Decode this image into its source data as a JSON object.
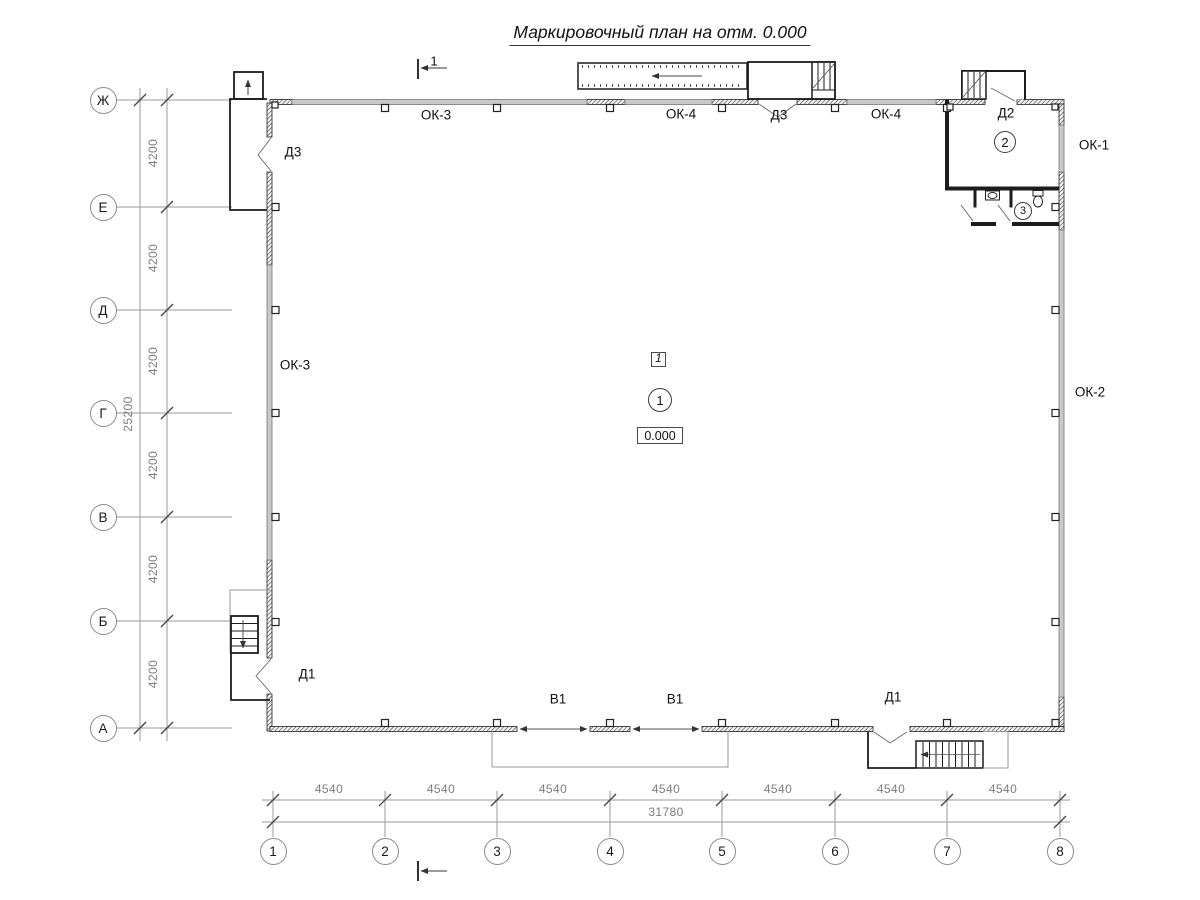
{
  "title": "Маркировочный план на отм. 0.000",
  "axes": {
    "rows": [
      "Ж",
      "Е",
      "Д",
      "Г",
      "В",
      "Б",
      "А"
    ],
    "cols": [
      "1",
      "2",
      "3",
      "4",
      "5",
      "6",
      "7",
      "8"
    ]
  },
  "dimensions": {
    "vertical_segments": [
      "4200",
      "4200",
      "4200",
      "4200",
      "4200",
      "4200"
    ],
    "vertical_total": "25200",
    "horizontal_segments": [
      "4540",
      "4540",
      "4540",
      "4540",
      "4540",
      "4540",
      "4540"
    ],
    "horizontal_total": "31780"
  },
  "marks": {
    "windows": {
      "ok1": "ОК-1",
      "ok2": "ОК-2",
      "ok3": "ОК-3",
      "ok4": "ОК-4"
    },
    "doors": {
      "d1": "Д1",
      "d2": "Д2",
      "d3": "Д3"
    },
    "gates": {
      "v1": "В1"
    },
    "rooms": {
      "r1": "1",
      "r2": "2",
      "r3": "3"
    },
    "level": "0.000",
    "floor_type": "1",
    "section": "1"
  },
  "colors": {
    "line": "#1c1c1c",
    "band": "#c9c9c9",
    "dim": "#7d7d7d"
  }
}
